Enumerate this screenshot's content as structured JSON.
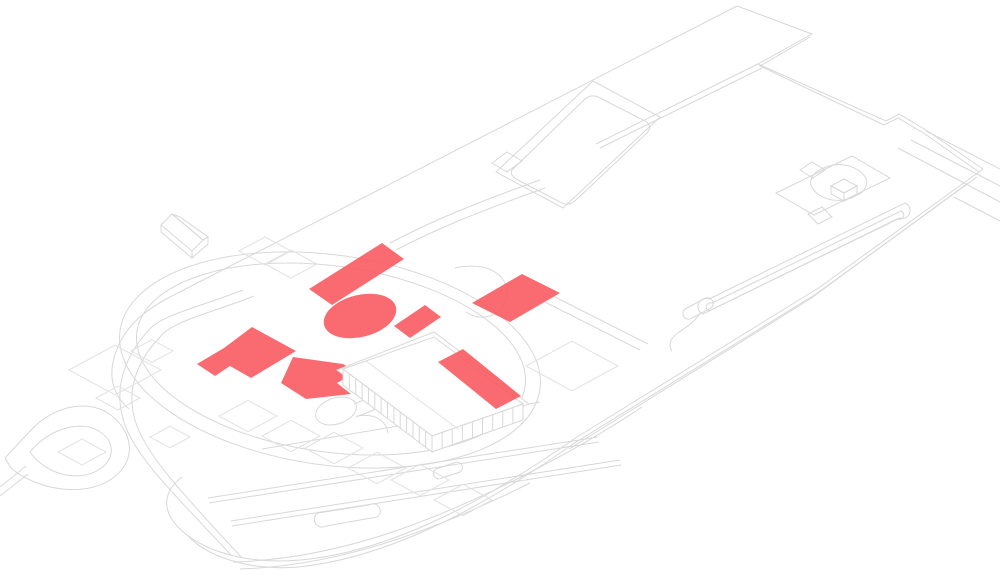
{
  "canvas": {
    "width": 1000,
    "height": 580,
    "background": "#ffffff"
  },
  "palette": {
    "highlight_red": "#f8575d",
    "line_gray": "#d8d8d8",
    "line_gray_light": "#e2e2e2",
    "building_white": "#ffffff",
    "highlight_opacity": 0.88
  },
  "diagram": {
    "type": "axonometric-site-plan",
    "description": "Isometric architectural site plan line drawing with red highlighted massing shapes",
    "linework": [
      {
        "name": "site-boundary-northeast",
        "d": "M737,6 L812,34 L758,64 L886,121 L899,114 L926,130 L983,169"
      },
      {
        "name": "site-boundary-southeast",
        "d": "M983,169 L820,287 L577,437 C470,512 380,553 300,560 C245,565 200,550 178,527 C160,508 165,490 182,477"
      },
      {
        "name": "site-boundary-northwest",
        "d": "M737,6 L168,298 C140,313 124,330 117,349 C107,374 112,394 129,409"
      },
      {
        "name": "site-edge-double-northeast",
        "d": "M810,37 L760,66 L884,125"
      },
      {
        "name": "site-corner-double-east",
        "d": "M884,125 L898,118 L925,134 L979,172"
      },
      {
        "name": "site-edge-inner-1",
        "d": "M977,177 L816,294 L573,444 C467,519 377,559 298,567 C250,571 208,557 188,536"
      },
      {
        "name": "site-edge-inner-2",
        "d": "M968,183 L810,299 L569,449"
      },
      {
        "name": "road-east-1",
        "d": "M926,131 L1000,169"
      },
      {
        "name": "road-east-2",
        "d": "M911,140 L1000,186"
      },
      {
        "name": "road-east-3",
        "d": "M898,148 L1000,202"
      },
      {
        "name": "road-east-4",
        "d": "M954,197 L1000,221"
      },
      {
        "name": "terrace-edge",
        "d": "M758,64 L596,144 M762,68 L600,148"
      },
      {
        "name": "sports-field-outline",
        "d": "M496,172 L593,81 L660,117 L563,208 Z"
      },
      {
        "name": "sports-field-step",
        "d": "M492,163 L507,152 L522,161 L507,172 Z"
      },
      {
        "name": "sports-field-inner",
        "d": "M512,170 L584,100 Q591,93 600,98 L645,121 Q653,126 647,133 L576,200 Q569,207 560,202 L518,180 Q509,175 512,170 Z"
      },
      {
        "name": "platform-outline",
        "d": "M776,193 L852,156 L890,178 L814,215 Z"
      },
      {
        "name": "platform-step",
        "d": "M800,170 L812,162 L825,170 L813,178 Z"
      },
      {
        "name": "platform-inner",
        "d": "M816,172 Q838,158 858,170 Q874,181 861,193 Q839,207 819,195 Q804,184 816,172 Z"
      },
      {
        "name": "platform-tab",
        "d": "M808,214 L822,207 L832,217 L818,224 Z"
      },
      {
        "name": "cube-top",
        "d": "M831,186 L844,179 L857,186 L844,193 Z"
      },
      {
        "name": "cube-left",
        "d": "M831,186 L844,193 L844,201 L831,194 Z"
      },
      {
        "name": "cube-right",
        "d": "M844,193 L857,186 L857,194 L844,201 Z"
      },
      {
        "name": "house-roof-left",
        "d": "M161,225 L172,214 L203,240 L192,251 Z"
      },
      {
        "name": "house-roof-right",
        "d": "M172,214 L180,217 L208,237 L203,240 Z"
      },
      {
        "name": "house-walls",
        "d": "M161,225 L161,232 L192,258 L192,251 M203,240 L208,237 L208,244 L192,258"
      },
      {
        "name": "lawn-ellipse-outer",
        "shape": "ellipse",
        "cx": 330,
        "cy": 360,
        "rx": 212,
        "ry": 105,
        "rot": 8
      },
      {
        "name": "lawn-ellipse-inner",
        "shape": "ellipse",
        "cx": 331,
        "cy": 359,
        "rx": 196,
        "ry": 93,
        "rot": 8
      },
      {
        "name": "road-south-curve-1",
        "d": "M243,290 C200,307 160,315 148,331 C125,356 112,390 125,425 C138,460 175,495 232,556"
      },
      {
        "name": "road-south-curve-2",
        "d": "M254,296 C214,312 172,321 160,337 C137,361 124,392 137,426 C150,460 186,497 242,558"
      },
      {
        "name": "loop-road-outer",
        "d": "M5,458 L32,429 C56,404 92,399 112,416 C134,434 136,461 113,478 C84,499 35,489 11,468 Z"
      },
      {
        "name": "loop-road-inner",
        "d": "M30,452 C48,430 78,420 97,430 C115,440 116,458 100,469 C79,483 46,475 30,452 Z"
      },
      {
        "name": "loop-road-tail",
        "d": "M0,487 L26,466 M0,496 L28,474"
      },
      {
        "name": "bottom-path-1",
        "d": "M233,562 C330,559 420,528 523,476 C560,457 602,434 642,407"
      },
      {
        "name": "bottom-path-2",
        "d": "M240,569 C335,566 428,534 530,483"
      },
      {
        "name": "path-capsule-long",
        "d": "M709,299 L905,203 A8,8 0 0 1 899,218 L703,314 A8,8 0 0 1 709,299 Z"
      },
      {
        "name": "path-capsule-long-inner",
        "d": "M712,303 L901,211 A4,4 0 0 1 898,219 L709,311 A4,4 0 0 1 712,303 Z"
      },
      {
        "name": "path-capsule-connector",
        "d": "M701,312 C694,323 686,327 678,333 C670,338 668,345 672,351"
      },
      {
        "name": "path-capsule-small",
        "d": "M685,309 L704,299 A5,5 0 0 1 711,308 L692,318 A5,5 0 0 1 685,309 Z"
      },
      {
        "name": "culdesac-oval",
        "shape": "ellipse",
        "cx": 336,
        "cy": 411,
        "rx": 21,
        "ry": 13,
        "rot": -18
      },
      {
        "name": "culdesac-stem",
        "d": "M354,404 L374,396 M356,417 L376,409"
      },
      {
        "name": "path-capsule-bottom",
        "d": "M318,513 L369,505 A7,7 0 0 1 377,517 L326,526 A7,7 0 0 1 318,513 Z"
      },
      {
        "name": "path-stub",
        "d": "M436,469 L454,463 A5,5 0 0 1 460,472 L442,478 A5,5 0 0 1 436,469 Z"
      },
      {
        "name": "garden-row-1",
        "d": "M208,498 L598,437 M209,503 L599,442"
      },
      {
        "name": "garden-row-2",
        "d": "M231,521 L620,460 M232,526 L621,465"
      },
      {
        "name": "garden-row-3",
        "d": "M262,449 L540,402"
      },
      {
        "name": "path-hook",
        "d": "M455,268 C492,260 512,279 506,300 C501,317 480,322 466,312"
      },
      {
        "name": "path-north-1",
        "d": "M390,243 C430,222 470,205 540,180"
      },
      {
        "name": "path-north-2",
        "d": "M396,250 C436,229 478,212 545,188"
      },
      {
        "name": "path-east-pair",
        "d": "M545,302 L640,350 M553,296 L648,344"
      },
      {
        "name": "building-path-curve",
        "d": "M357,416 C376,413 386,421 388,433"
      }
    ],
    "plots": [
      [
        265,
        251,
        52
      ],
      [
        291,
        264,
        52
      ],
      [
        115,
        370,
        92
      ],
      [
        152,
        351,
        42
      ],
      [
        82,
        452,
        48
      ],
      [
        118,
        398,
        44
      ],
      [
        170,
        437,
        40
      ],
      [
        248,
        416,
        58
      ],
      [
        334,
        448,
        58
      ],
      [
        420,
        480,
        58
      ],
      [
        291,
        436,
        58
      ],
      [
        377,
        468,
        58
      ],
      [
        463,
        500,
        58
      ],
      [
        572,
        366,
        92
      ]
    ],
    "building": {
      "plinth": "M337,370 L434,332 L529,404 L433,442 Z",
      "roof": "M343,369 L434,337 L523,404 L432,436 Z",
      "facade_left": "M343,369 L432,436 L432,452 L343,385 Z",
      "facade_right": "M432,436 L523,404 L523,420 L432,452 Z",
      "roof_line": "M366,361 L458,429",
      "colonnade": [
        {
          "name": "colonnade-southwest",
          "from": [
            343,
            369
          ],
          "to": [
            432,
            436
          ],
          "count": 13,
          "drop": 16
        },
        {
          "name": "colonnade-southeast",
          "from": [
            432,
            436
          ],
          "to": [
            523,
            404
          ],
          "count": 8,
          "drop": 16
        }
      ]
    },
    "highlights": [
      {
        "name": "highlight-bar-northwest",
        "shape": "polygon",
        "points": "309,289 382,243 404,259 332,305"
      },
      {
        "name": "highlight-ellipse",
        "shape": "ellipse",
        "cx": 360,
        "cy": 316,
        "rx": 37,
        "ry": 21,
        "rot": -14
      },
      {
        "name": "highlight-bar-middle",
        "shape": "polygon",
        "points": "394,326 425,305 441,317 410,338"
      },
      {
        "name": "highlight-bar-northeast",
        "shape": "polygon",
        "points": "472,303 522,274 560,293 510,322"
      },
      {
        "name": "highlight-bar-west-stepped",
        "shape": "polygon",
        "points": "252,327 296,351 251,378 230,366 215,376 197,364 224,348"
      },
      {
        "name": "highlight-arrow",
        "shape": "polygon",
        "points": "293,357 343,364 356,372 337,383 351,394 306,399 281,383"
      }
    ],
    "highlights_over_building": [
      {
        "name": "highlight-bar-roof",
        "shape": "polygon",
        "points": "438,362 463,349 521,396 496,409"
      }
    ]
  }
}
